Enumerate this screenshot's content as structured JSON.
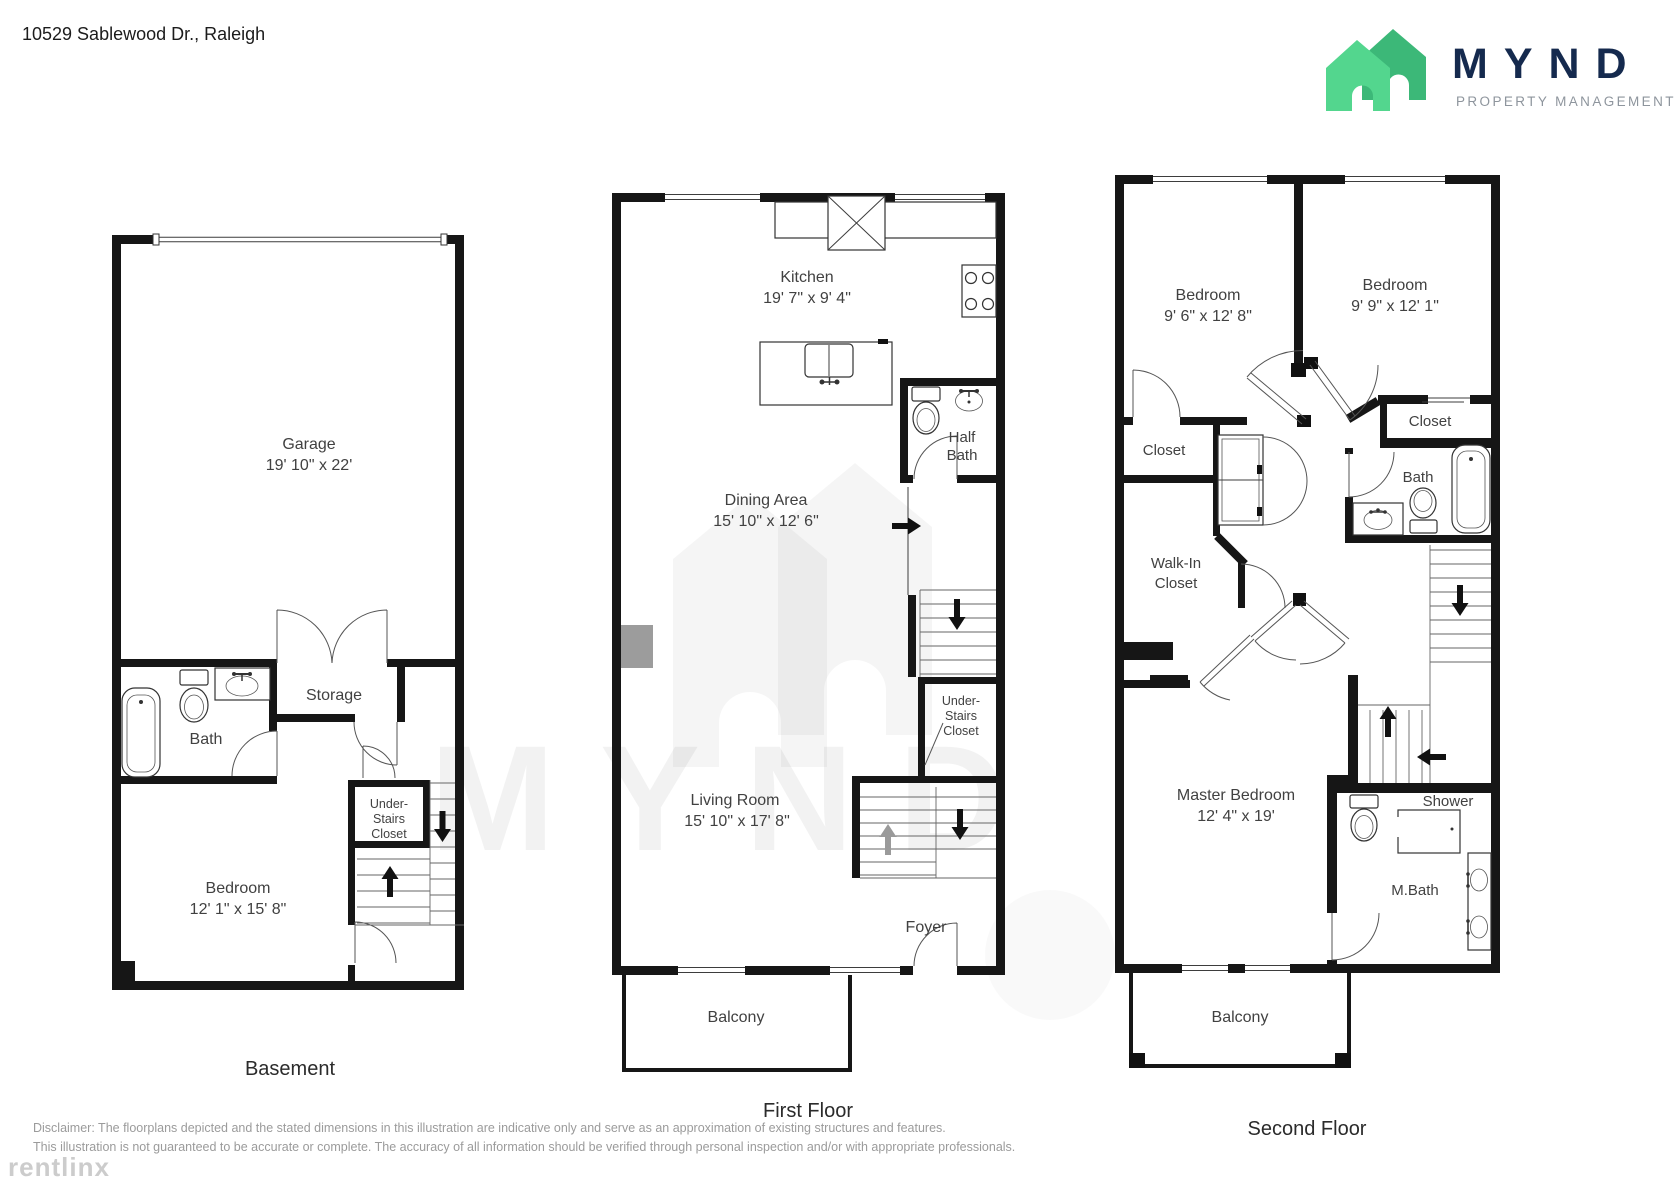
{
  "page": {
    "address": "10529 Sablewood Dr., Raleigh"
  },
  "logo": {
    "brand": "MYND",
    "tagline": "PROPERTY MANAGEMENT"
  },
  "watermarks": {
    "brand_text": "MYND",
    "provider": "rentlinx"
  },
  "floors": {
    "basement": {
      "title": "Basement",
      "garage_name": "Garage",
      "garage_dims": "19' 10\" x 22'",
      "bath": "Bath",
      "storage": "Storage",
      "understairs_line1": "Under-",
      "understairs_line2": "Stairs",
      "understairs_line3": "Closet",
      "bedroom_name": "Bedroom",
      "bedroom_dims": "12' 1\" x 15' 8\""
    },
    "first": {
      "title": "First Floor",
      "kitchen_name": "Kitchen",
      "kitchen_dims": "19' 7\" x 9' 4\"",
      "halfbath_line1": "Half",
      "halfbath_line2": "Bath",
      "dining_name": "Dining Area",
      "dining_dims": "15' 10\" x 12' 6\"",
      "understairs_line1": "Under-",
      "understairs_line2": "Stairs",
      "understairs_line3": "Closet",
      "living_name": "Living Room",
      "living_dims": "15' 10\" x 17' 8\"",
      "foyer": "Foyer",
      "balcony": "Balcony"
    },
    "second": {
      "title": "Second Floor",
      "bedroom1_name": "Bedroom",
      "bedroom1_dims": "9' 6\" x 12' 8\"",
      "bedroom2_name": "Bedroom",
      "bedroom2_dims": "9' 9\" x 12' 1\"",
      "closet_left": "Closet",
      "closet_right": "Closet",
      "bath": "Bath",
      "walkin_line1": "Walk-In",
      "walkin_line2": "Closet",
      "master_name": "Master Bedroom",
      "master_dims": "12' 4\" x 19'",
      "shower": "Shower",
      "mbath": "M.Bath",
      "balcony": "Balcony"
    }
  },
  "footer": {
    "disclaimer_line1": "Disclaimer: The floorplans depicted and the stated dimensions in this illustration are indicative only and serve as an approximation of existing structures and features.",
    "disclaimer_line2": "This illustration is not guaranteed to be accurate or complete. The accuracy of all information should be verified through personal inspection and/or with appropriate professionals."
  },
  "colors": {
    "wall": "#161616",
    "accent_green_front": "#53d68e",
    "accent_green_back": "#3cb878",
    "brand_navy": "#152a4e",
    "gray_text": "#9b9b9b"
  }
}
